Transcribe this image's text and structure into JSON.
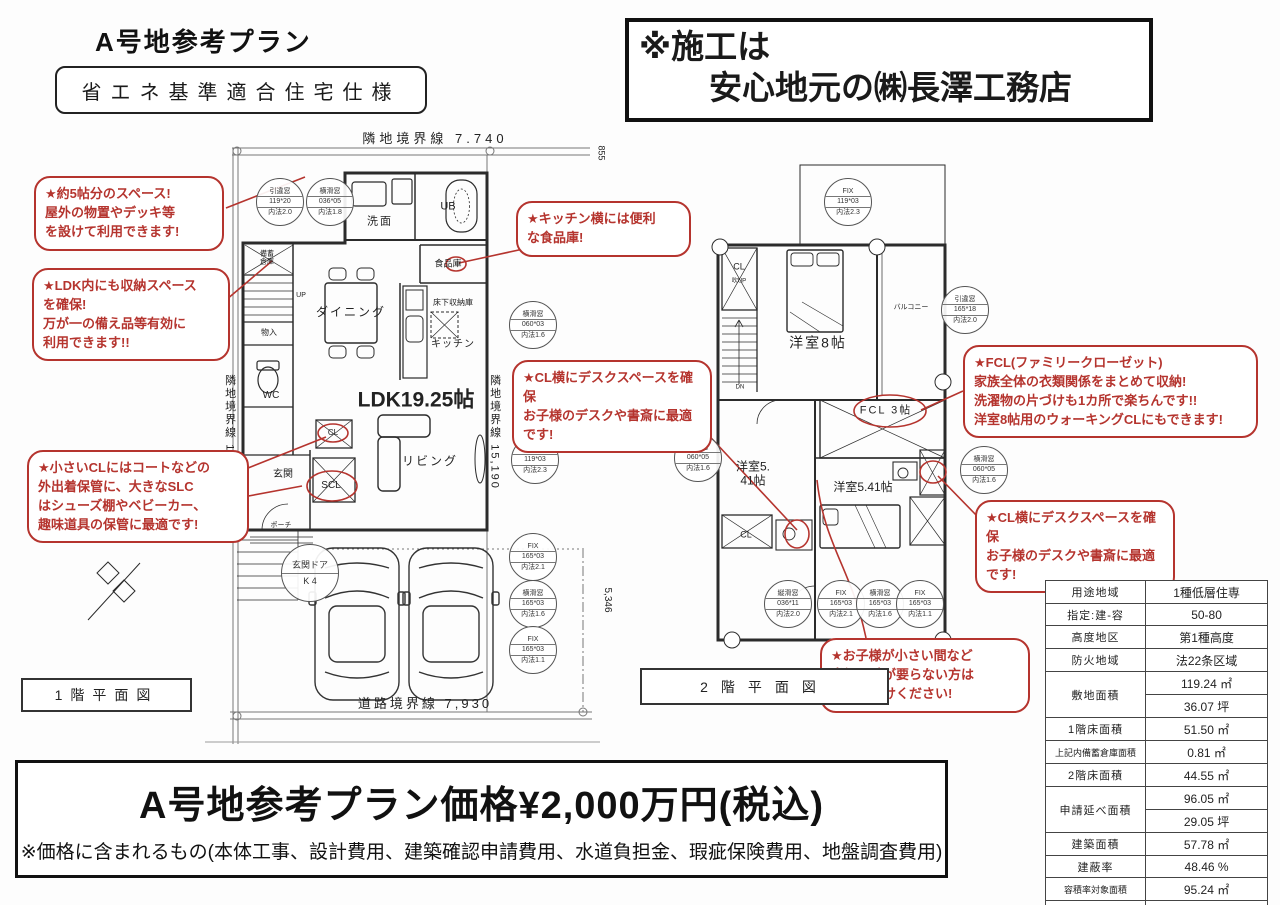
{
  "colors": {
    "annotation_red": "#b5342e",
    "plan_line": "#2b2b2b"
  },
  "page": {
    "title": "A号地参考プラン",
    "spec_badge": "省エネ基準適合住宅仕様",
    "builder_line1": "※施工は",
    "builder_line2": "安心地元の㈱長澤工務店"
  },
  "price": {
    "main": "A号地参考プラン価格¥2,000万円(税込)",
    "note": "※価格に含まれるもの(本体工事、設計費用、建築確認申請費用、水道負担金、瑕疵保険費用、地盤調査費用)"
  },
  "floor1": {
    "caption": "1階平面図",
    "labels": [
      {
        "text": "隣地境界線 7.740",
        "x": 435,
        "y": 139,
        "s": 13,
        "ls": 4,
        "name": "boundary-top-label"
      },
      {
        "text": "855",
        "x": 601,
        "y": 153,
        "s": 9,
        "v": 1,
        "name": "dim-855"
      },
      {
        "text": "隣地境界線 15,240",
        "x": 229,
        "y": 432,
        "s": 11,
        "v": 1,
        "ls": 2,
        "name": "boundary-left-label"
      },
      {
        "text": "隣地境界線 15,190",
        "x": 494,
        "y": 432,
        "s": 11,
        "v": 1,
        "ls": 2,
        "name": "boundary-right-label"
      },
      {
        "text": "道路境界線 7,930",
        "x": 425,
        "y": 704,
        "s": 13,
        "ls": 3,
        "name": "boundary-road-label"
      },
      {
        "text": "5,346",
        "x": 607,
        "y": 600,
        "s": 10,
        "v": 1,
        "name": "dim-5346"
      },
      {
        "text": "洗面",
        "x": 380,
        "y": 222,
        "s": 11,
        "ls": 2
      },
      {
        "text": "UB",
        "x": 448,
        "y": 207,
        "s": 11
      },
      {
        "text": "食品庫",
        "x": 448,
        "y": 264,
        "s": 9
      },
      {
        "text": "ダイニング",
        "x": 351,
        "y": 312,
        "s": 12,
        "ls": 2
      },
      {
        "text": "床下収納庫",
        "x": 453,
        "y": 303,
        "s": 8
      },
      {
        "text": "キッチン",
        "x": 453,
        "y": 345,
        "s": 10,
        "ls": 1
      },
      {
        "text": "LDK19.25帖",
        "x": 416,
        "y": 400,
        "s": 21,
        "b": 1
      },
      {
        "text": "リビング",
        "x": 430,
        "y": 461,
        "s": 12,
        "ls": 2
      },
      {
        "text": "WC",
        "x": 271,
        "y": 396,
        "s": 10
      },
      {
        "text": "物入",
        "x": 269,
        "y": 333,
        "s": 8
      },
      {
        "text": "UP",
        "x": 301,
        "y": 296,
        "s": 7
      },
      {
        "text": "備蓄\n倉庫",
        "x": 267,
        "y": 259,
        "s": 7
      },
      {
        "text": "玄関",
        "x": 283,
        "y": 475,
        "s": 10
      },
      {
        "text": "SCL",
        "x": 331,
        "y": 486,
        "s": 10
      },
      {
        "text": "CL",
        "x": 333,
        "y": 433,
        "s": 8
      },
      {
        "text": "ポーチ",
        "x": 281,
        "y": 526,
        "s": 7
      }
    ],
    "windows": [
      {
        "x": 280,
        "y": 202,
        "type": "引違窓",
        "size": "119*20",
        "inner": "内法2.0"
      },
      {
        "x": 330,
        "y": 202,
        "type": "横滑窓",
        "size": "036*05",
        "inner": "内法1.8"
      },
      {
        "x": 533,
        "y": 325,
        "type": "横滑窓",
        "size": "060*03",
        "inner": "内法1.6"
      },
      {
        "x": 535,
        "y": 460,
        "type": "FIX",
        "size": "119*03",
        "inner": "内法2.3"
      },
      {
        "x": 533,
        "y": 557,
        "type": "FIX",
        "size": "165*03",
        "inner": "内法2.1"
      },
      {
        "x": 533,
        "y": 604,
        "type": "横滑窓",
        "size": "165*03",
        "inner": "内法1.6"
      },
      {
        "x": 533,
        "y": 650,
        "type": "FIX",
        "size": "165*03",
        "inner": "内法1.1"
      },
      {
        "x": 310,
        "y": 573,
        "type": "玄関ドア",
        "size": "K 4",
        "inner": "",
        "door": true
      }
    ]
  },
  "floor2": {
    "caption": "2階平面図",
    "labels": [
      {
        "text": "CL",
        "x": 739,
        "y": 267,
        "s": 9
      },
      {
        "text": "吹UP",
        "x": 739,
        "y": 282,
        "s": 6
      },
      {
        "text": "洋室8帖",
        "x": 818,
        "y": 343,
        "s": 14,
        "ls": 2
      },
      {
        "text": "バルコニー",
        "x": 911,
        "y": 308,
        "s": 7
      },
      {
        "text": "FCL 3帖",
        "x": 886,
        "y": 411,
        "s": 11,
        "ls": 2
      },
      {
        "text": "洋室5.\n41帖",
        "x": 753,
        "y": 474,
        "s": 12
      },
      {
        "text": "洋室5.41帖",
        "x": 863,
        "y": 487,
        "s": 12
      },
      {
        "text": "CL",
        "x": 746,
        "y": 535,
        "s": 9
      },
      {
        "text": "DN",
        "x": 740,
        "y": 388,
        "s": 6
      }
    ],
    "windows": [
      {
        "x": 848,
        "y": 202,
        "type": "FIX",
        "size": "119*03",
        "inner": "内法2.3"
      },
      {
        "x": 965,
        "y": 310,
        "type": "引違窓",
        "size": "165*18",
        "inner": "内法2.0"
      },
      {
        "x": 698,
        "y": 458,
        "type": "横滑窓",
        "size": "060*05",
        "inner": "内法1.6"
      },
      {
        "x": 984,
        "y": 470,
        "type": "横滑窓",
        "size": "060*05",
        "inner": "内法1.6"
      },
      {
        "x": 788,
        "y": 604,
        "type": "縦滑窓",
        "size": "036*11",
        "inner": "内法2.0"
      },
      {
        "x": 841,
        "y": 604,
        "type": "FIX",
        "size": "165*03",
        "inner": "内法2.1"
      },
      {
        "x": 880,
        "y": 604,
        "type": "横滑窓",
        "size": "165*03",
        "inner": "内法1.6"
      },
      {
        "x": 920,
        "y": 604,
        "type": "FIX",
        "size": "165*03",
        "inner": "内法1.1"
      }
    ]
  },
  "annotations": [
    {
      "id": "outdoor-space",
      "x": 34,
      "y": 176,
      "w": 190,
      "text": "★約5帖分のスペース!\n屋外の物置やデッキ等\nを設けて利用できます!"
    },
    {
      "id": "ldk-storage",
      "x": 32,
      "y": 268,
      "w": 198,
      "text": "★LDK内にも収納スペース\nを確保!\n万が一の備え品等有効に\n利用できます!!"
    },
    {
      "id": "scl-closet",
      "x": 27,
      "y": 450,
      "w": 222,
      "text": "★小さいCLにはコートなどの\n外出着保管に、大きなSLC\nはシューズ棚やベビーカー、\n趣味道具の保管に最適です!"
    },
    {
      "id": "pantry",
      "x": 516,
      "y": 201,
      "w": 175,
      "text": "★キッチン横には便利\nな食品庫!"
    },
    {
      "id": "desk-floor1",
      "x": 512,
      "y": 360,
      "w": 200,
      "text": "★CL横にデスクスペースを確保\nお子様のデスクや書斎に最適\nです!"
    },
    {
      "id": "fcl",
      "x": 963,
      "y": 345,
      "w": 295,
      "text": "★FCL(ファミリークローゼット)\n家族全体の衣類関係をまとめて収納!\n洗濯物の片づけも1カ所で楽ちんです!!\n洋室8帖用のウォーキングCLにもできます!"
    },
    {
      "id": "desk-floor2",
      "x": 975,
      "y": 500,
      "w": 200,
      "text": "★CL横にデスクスペースを確保\nお子様のデスクや書斎に最適\nです!"
    },
    {
      "id": "removable-wall",
      "x": 820,
      "y": 638,
      "w": 210,
      "text": "★お子様が小さい間など\n当初は壁が要らない方は\nご申し付けください!"
    }
  ],
  "spec_table": {
    "rows": [
      {
        "label": "用途地域",
        "value": "1種低層住専"
      },
      {
        "label": "指定:建-容",
        "value": "50-80"
      },
      {
        "label": "高度地区",
        "value": "第1種高度"
      },
      {
        "label": "防火地域",
        "value": "法22条区域"
      },
      {
        "label": "敷地面積",
        "value": "119.24 ㎡",
        "span": 2
      },
      {
        "value": "36.07 坪"
      },
      {
        "label": "1階床面積",
        "value": "51.50 ㎡"
      },
      {
        "label": "上記内備蓄倉庫面積",
        "value": "0.81 ㎡",
        "small": true
      },
      {
        "label": "2階床面積",
        "value": "44.55 ㎡"
      },
      {
        "label": "申請延べ面積",
        "value": "96.05 ㎡",
        "span": 2
      },
      {
        "value": "29.05 坪"
      },
      {
        "label": "建築面積",
        "value": "57.78 ㎡"
      },
      {
        "label": "建蔽率",
        "value": "48.46 %"
      },
      {
        "label": "容積率対象面積",
        "value": "95.24 ㎡",
        "small": true
      },
      {
        "label": "容積率",
        "value": "79.88 %"
      }
    ]
  }
}
